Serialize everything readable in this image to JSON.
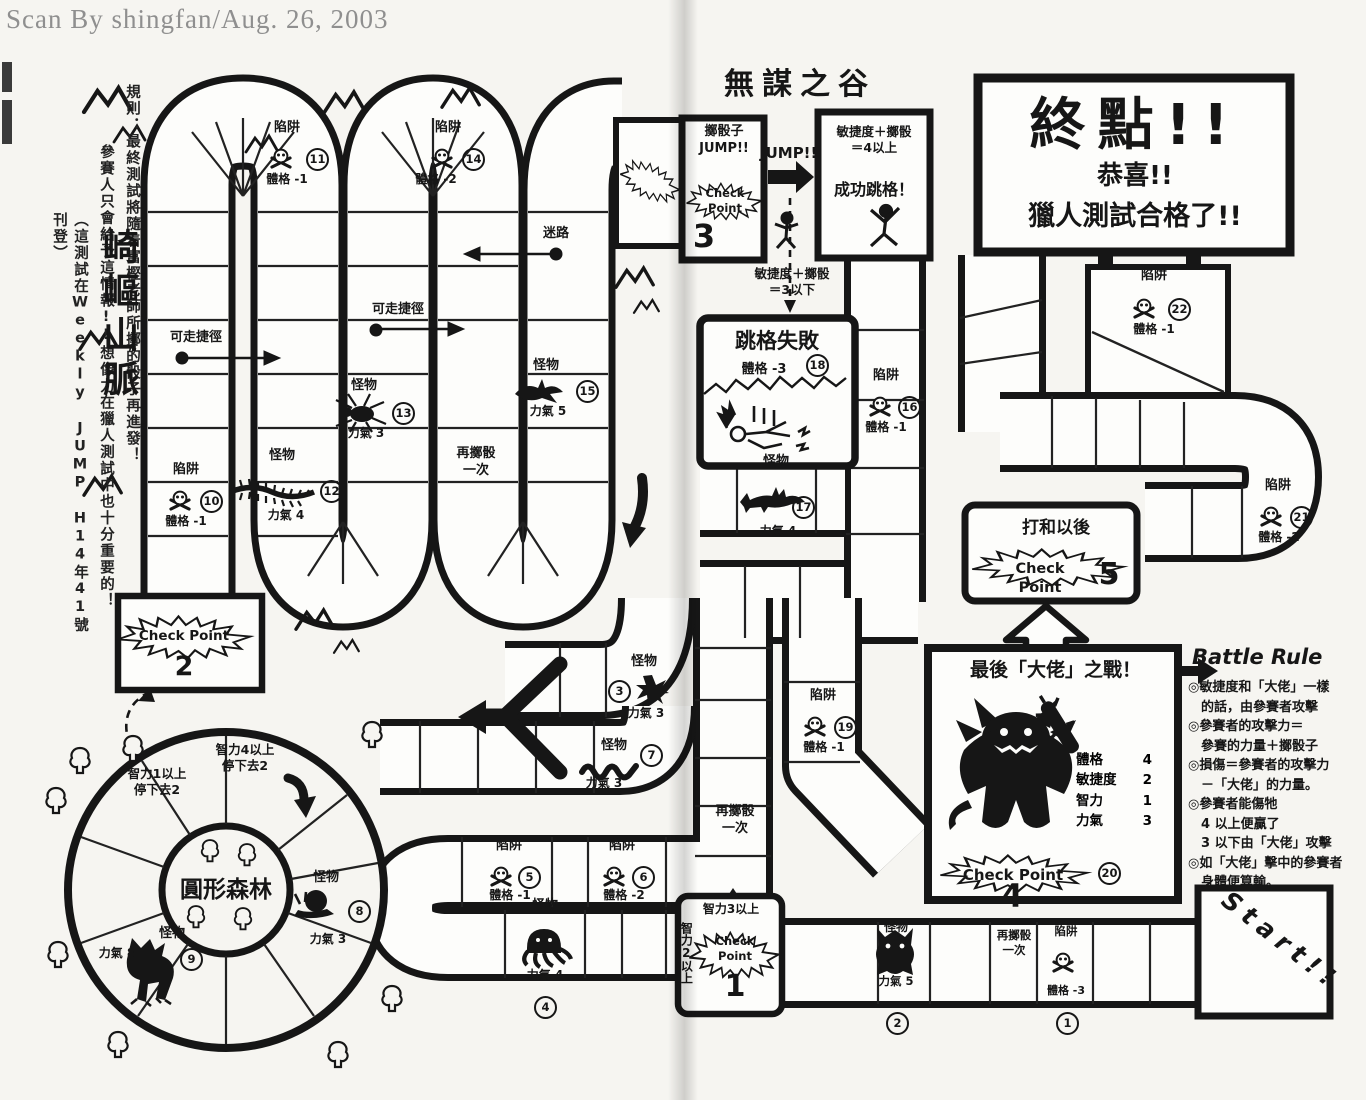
{
  "credit": "Scan By shingfan/Aug. 26, 2003",
  "rules": {
    "line1": "規則：最終測試將隨着富樫老師所擲的骰子再進發！",
    "line2": "參賽人只會給予這情報!!想像力在獵人測試中也十分重要的！",
    "line3": "（這測試在Weekly JUMP H14年41號刊登）"
  },
  "regions": {
    "mountain": "崎嶇山脈",
    "valley": "無謀之谷",
    "forest": "圓形森林"
  },
  "goal": {
    "title": "終點!!",
    "congrats": "恭喜!!",
    "passed": "獵人測試合格了!!"
  },
  "start_label": "Start!!",
  "cp_word": "Check Point",
  "checkpoints": {
    "c1": {
      "num": "1",
      "top": "智力3以上",
      "side": "智力2以上"
    },
    "c2": {
      "num": "2"
    },
    "c3": {
      "num": "3",
      "title": "擲骰子\nJUMP!!"
    },
    "c4": {
      "num": "4"
    },
    "c5": {
      "num": "5",
      "title": "打和以後"
    }
  },
  "jump": {
    "label": "JUMP!!",
    "success_cond": "敏捷度＋擲骰\n＝4以上",
    "success_result": "成功跳格！",
    "fail_cond": "敏捷度＋擲骰\n＝3以下",
    "fail_title": "跳格失敗",
    "fail_effect": "體格 -3",
    "fail_num": "18"
  },
  "boss": {
    "title": "最後「大佬」之戰！",
    "num": "20",
    "stats": [
      {
        "k": "體格",
        "v": "4"
      },
      {
        "k": "敏捷度",
        "v": "2"
      },
      {
        "k": "智力",
        "v": "1"
      },
      {
        "k": "力氣",
        "v": "3"
      }
    ]
  },
  "battle_rule": {
    "title": "Battle Rule",
    "body": "◎敏捷度和「大佬」一樣\n　的話，由參賽者攻擊\n◎參賽者的攻擊力＝\n　參賽的力量＋擲骰子\n◎損傷＝參賽者的攻擊力\n　－「大佬」的力量。\n◎參賽者能傷牠\n　4 以上便贏了\n　3 以下由「大佬」攻擊\n◎如「大佬」擊中的參賽者\n　身體便算輸。"
  },
  "trap_word": "陷阱",
  "monster_word": "怪物",
  "traps": [
    {
      "num": "1",
      "effect": "體格 -3"
    },
    {
      "num": "5",
      "effect": "體格 -1"
    },
    {
      "num": "6",
      "effect": "體格 -2"
    },
    {
      "num": "10",
      "effect": "體格 -1"
    },
    {
      "num": "11",
      "effect": "體格 -1"
    },
    {
      "num": "14",
      "effect": "體格 -2"
    },
    {
      "num": "16",
      "effect": "體格 -1"
    },
    {
      "num": "19",
      "effect": "體格 -1"
    },
    {
      "num": "21",
      "effect": "體格 -2"
    },
    {
      "num": "22",
      "effect": "體格 -1"
    }
  ],
  "monsters": [
    {
      "num": "2",
      "power": "力氣 5"
    },
    {
      "num": "3",
      "power": "力氣 3"
    },
    {
      "num": "4",
      "power": "力氣 4"
    },
    {
      "num": "7",
      "power": "力氣 3"
    },
    {
      "num": "8",
      "power": "力氣 3"
    },
    {
      "num": "9",
      "power": "力氣 8"
    },
    {
      "num": "12",
      "power": "力氣 4"
    },
    {
      "num": "13",
      "power": "力氣 3"
    },
    {
      "num": "15",
      "power": "力氣 5"
    },
    {
      "num": "17",
      "power": "力氣 4"
    }
  ],
  "path_labels": {
    "shortcut": "可走捷徑",
    "lost": "迷路",
    "reroll": "再擲骰\n一次",
    "forest_rule1": "智力1以上\n停下去2",
    "forest_rule2": "智力4以上\n停下去2"
  }
}
